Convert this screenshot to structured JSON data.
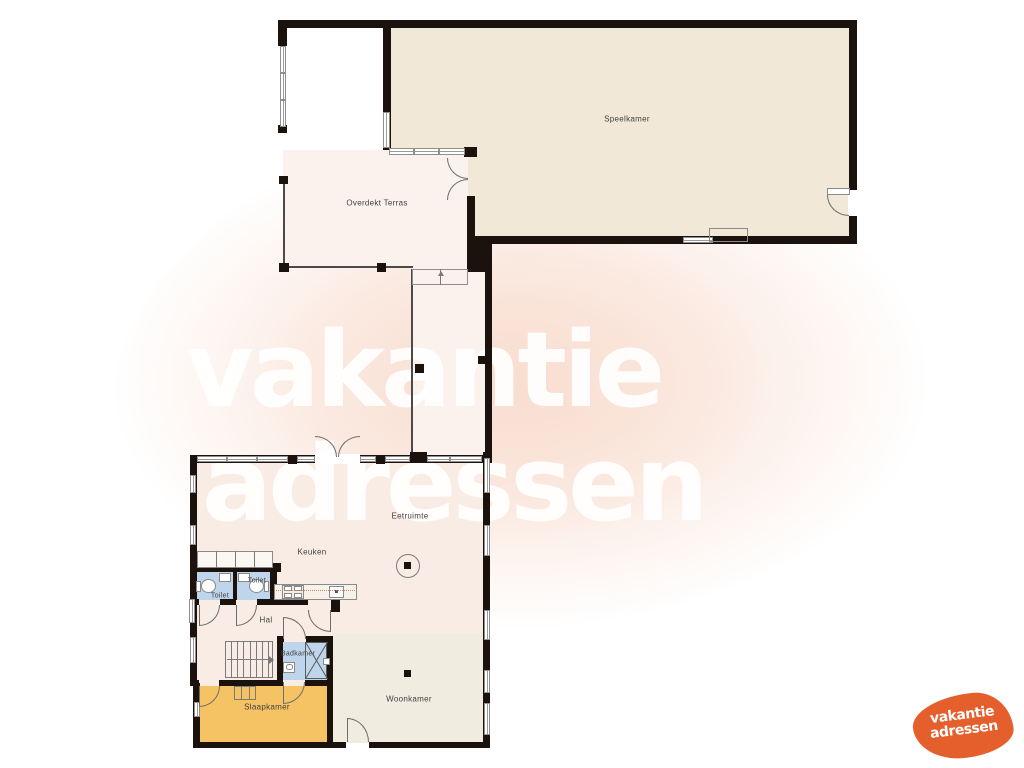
{
  "watermark": {
    "line1": "vakantie",
    "line2": "adressen"
  },
  "logo": {
    "line1": "vakantie",
    "line2": "adressen",
    "color": "#e55f2d"
  },
  "rooms": [
    {
      "id": "speelkamer",
      "label": "Speelkamer"
    },
    {
      "id": "overdekt-terras",
      "label": "Overdekt Terras"
    },
    {
      "id": "eetruimte",
      "label": "Eetruimte"
    },
    {
      "id": "keuken",
      "label": "Keuken"
    },
    {
      "id": "hal",
      "label": "Hal"
    },
    {
      "id": "toilet-1",
      "label": "Toilet"
    },
    {
      "id": "toilet-2",
      "label": "Toilet"
    },
    {
      "id": "badkamer",
      "label": "Badkamer"
    },
    {
      "id": "slaapkamer",
      "label": "Slaapkamer"
    },
    {
      "id": "woonkamer",
      "label": "Woonkamer"
    }
  ],
  "colors": {
    "wall": "#1b120d",
    "speelkamer_floor": "#f1e8d7",
    "terras_floor": "#fcf2ed",
    "living_floor": "#f9ece5",
    "woonkamer_floor": "#f0ecdf",
    "slaapkamer_floor": "#f6c364",
    "sanitary_floor": "#bfd5ec",
    "logo_orange": "#e55f2d",
    "watermark_tint": "#f9e0d3"
  }
}
